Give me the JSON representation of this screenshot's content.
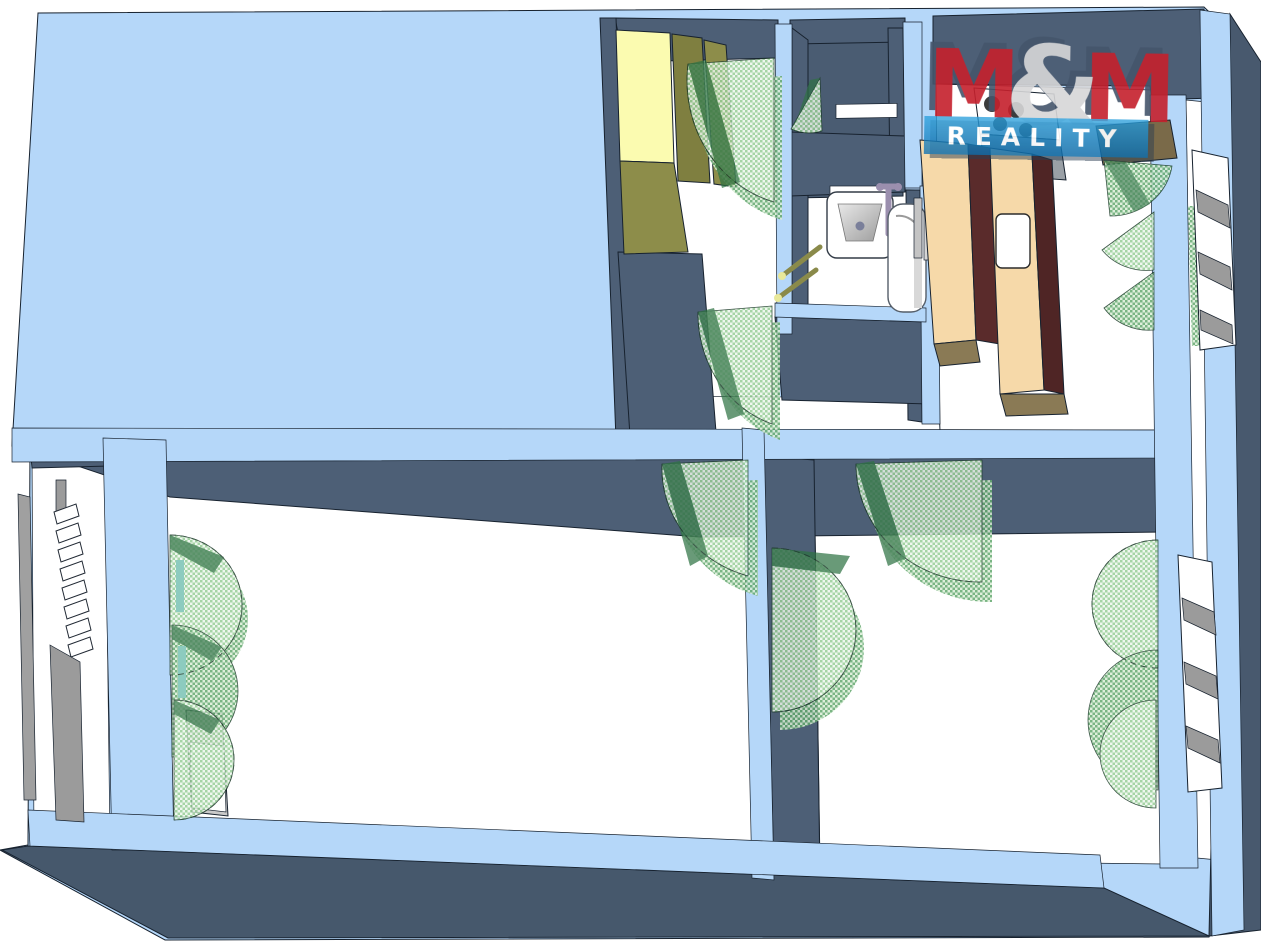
{
  "logo": {
    "m_left": "M",
    "ampersand": "&",
    "m_right": "M",
    "banner": "REALITY"
  },
  "colors": {
    "background": "#ffffff",
    "exterior_wall_top": "#b5d7f9",
    "interior_wall_face": "#4d5f76",
    "floor": "#ffffff",
    "door_swing_light_green": "#96cd96",
    "door_swing_mid_green": "#63a86e",
    "door_leaf_dark_green": "#2e7243",
    "wardrobe_top_yellow": "#fbfbb0",
    "wardrobe_front_olive": "#8d8d4a",
    "kitchen_counter_top": "#f6d9a9",
    "kitchen_counter_side": "#53282a",
    "kitchen_counter_base": "#8a7a55",
    "stove_front_gray": "#9aa0a6",
    "stairs_gray": "#9b9b9b",
    "logo_red": "#c5202c",
    "logo_ampersand_gray": "#d6d6d8",
    "logo_banner_blue": "#1387c6",
    "logo_text_white": "#ffffff"
  }
}
